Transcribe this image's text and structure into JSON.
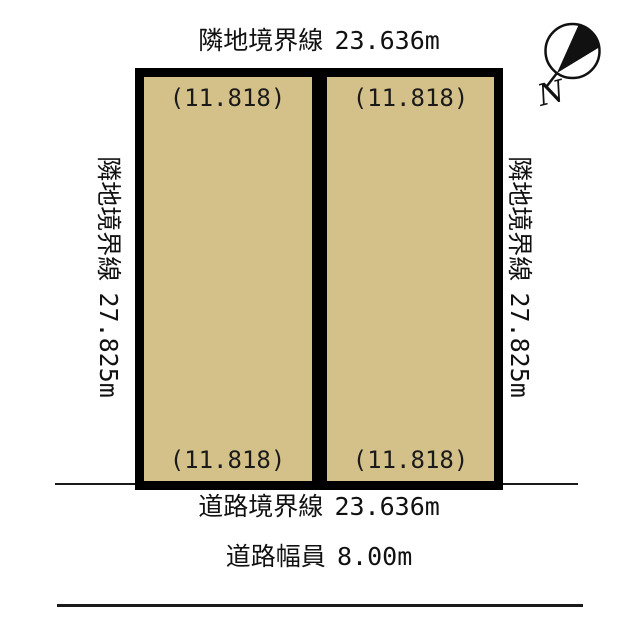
{
  "diagram": {
    "type": "land-plot-site-plan",
    "compass": {
      "label": "N"
    },
    "boundaries": {
      "top": {
        "label": "隣地境界線",
        "value": "23.636m"
      },
      "left": {
        "label": "隣地境界線",
        "value": "27.825m"
      },
      "right": {
        "label": "隣地境界線",
        "value": "27.825m"
      },
      "road": {
        "label": "道路境界線",
        "value": "23.636m"
      },
      "road_width": {
        "label": "道路幅員",
        "value": "8.00m"
      }
    },
    "parcels": [
      {
        "top_value": "(11.818)",
        "bottom_value": "(11.818)"
      },
      {
        "top_value": "(11.818)",
        "bottom_value": "(11.818)"
      }
    ],
    "colors": {
      "parcel_fill": "#d4c189",
      "outline": "#000000",
      "background": "#ffffff"
    }
  }
}
